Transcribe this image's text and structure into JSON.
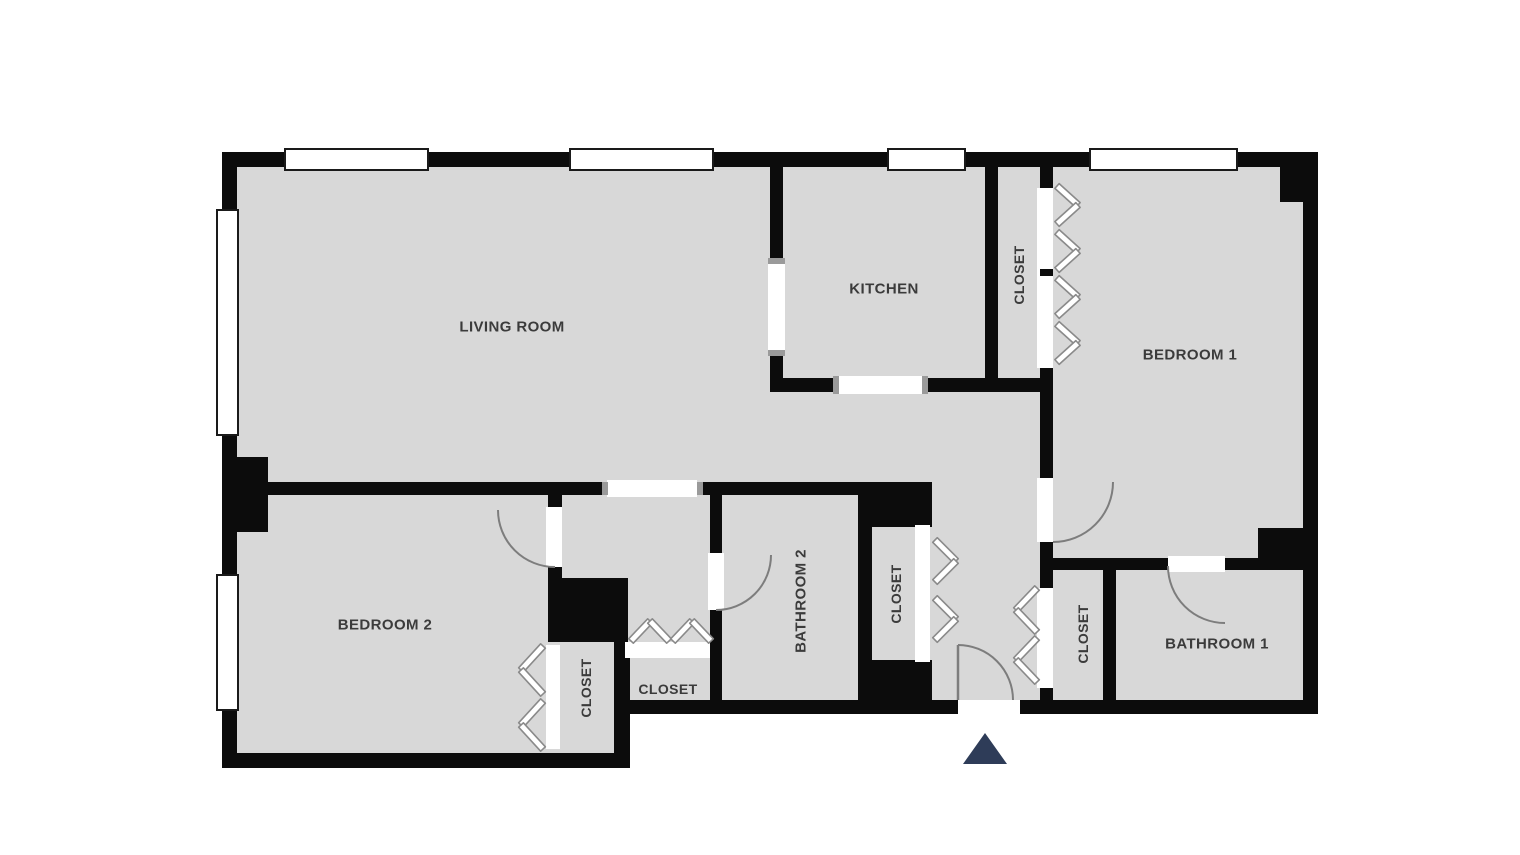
{
  "title": "Apartment floor plan",
  "colors": {
    "background": "#ffffff",
    "floor": "#d8d8d8",
    "wall": "#0c0c0c",
    "opening": "#ffffff",
    "window_border": "#1a1a1a",
    "door_arc": "#7d7d7d",
    "bifold": "#8a8a8a",
    "cap": "#9a9a9a",
    "label": "#3b3b3b",
    "entry_marker": "#2e3c58"
  },
  "rooms": [
    {
      "name": "living-room",
      "label": "LIVING ROOM",
      "x": 512,
      "y": 326,
      "orientation": "horizontal",
      "font": 15
    },
    {
      "name": "kitchen",
      "label": "KITCHEN",
      "x": 884,
      "y": 288,
      "orientation": "horizontal",
      "font": 15
    },
    {
      "name": "closet-kitchen",
      "label": "CLOSET",
      "x": 1019,
      "y": 275,
      "orientation": "vertical",
      "font": 14
    },
    {
      "name": "bedroom-1",
      "label": "BEDROOM 1",
      "x": 1190,
      "y": 354,
      "orientation": "horizontal",
      "font": 15
    },
    {
      "name": "bedroom-2",
      "label": "BEDROOM 2",
      "x": 385,
      "y": 624,
      "orientation": "horizontal",
      "font": 15
    },
    {
      "name": "closet-bedroom-2",
      "label": "CLOSET",
      "x": 586,
      "y": 688,
      "orientation": "vertical",
      "font": 14
    },
    {
      "name": "closet-hall",
      "label": "CLOSET",
      "x": 668,
      "y": 689,
      "orientation": "horizontal",
      "font": 14
    },
    {
      "name": "bathroom-2",
      "label": "BATHROOM 2",
      "x": 800,
      "y": 601,
      "orientation": "vertical",
      "font": 15
    },
    {
      "name": "closet-bathroom",
      "label": "CLOSET",
      "x": 896,
      "y": 594,
      "orientation": "vertical",
      "font": 14
    },
    {
      "name": "closet-entry",
      "label": "CLOSET",
      "x": 1083,
      "y": 634,
      "orientation": "vertical",
      "font": 14
    },
    {
      "name": "bathroom-1",
      "label": "BATHROOM 1",
      "x": 1217,
      "y": 643,
      "orientation": "horizontal",
      "font": 15
    }
  ],
  "icons": {
    "bifold_door": "chevron-pair",
    "swing_door": "quarter-arc",
    "entry_marker": "triangle-up",
    "window": "white-bar-in-wall"
  }
}
